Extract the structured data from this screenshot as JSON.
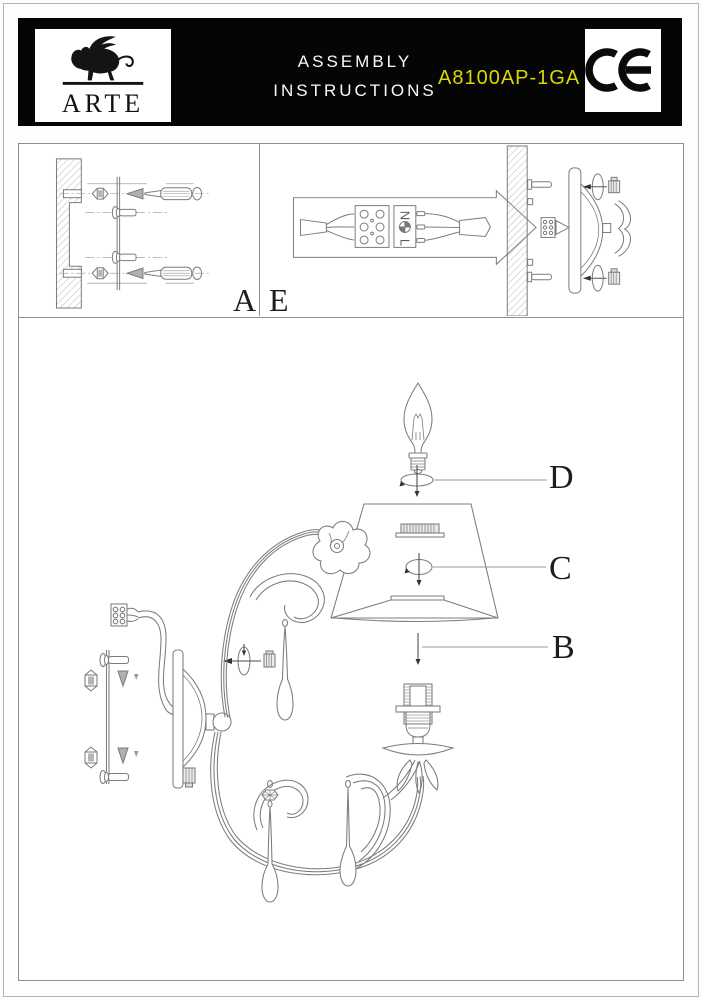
{
  "header": {
    "brand": "ARTE",
    "title_line1": "ASSEMBLY",
    "title_line2": "INSTRUCTIONS",
    "model": "A8100AP-1GA",
    "model_color": "#d9d900",
    "ce_mark": "CE"
  },
  "figures": {
    "panel_a_label": "A",
    "panel_e_label": "E",
    "step_d_label": "D",
    "step_c_label": "C",
    "step_b_label": "B"
  },
  "wiring": {
    "neutral_label": "N",
    "line_label": "L",
    "earth_icon": "earth-ground-symbol"
  },
  "colors": {
    "header_bg": "#050505",
    "line": "#7c7c7c",
    "page_bg": "#ffffff"
  }
}
